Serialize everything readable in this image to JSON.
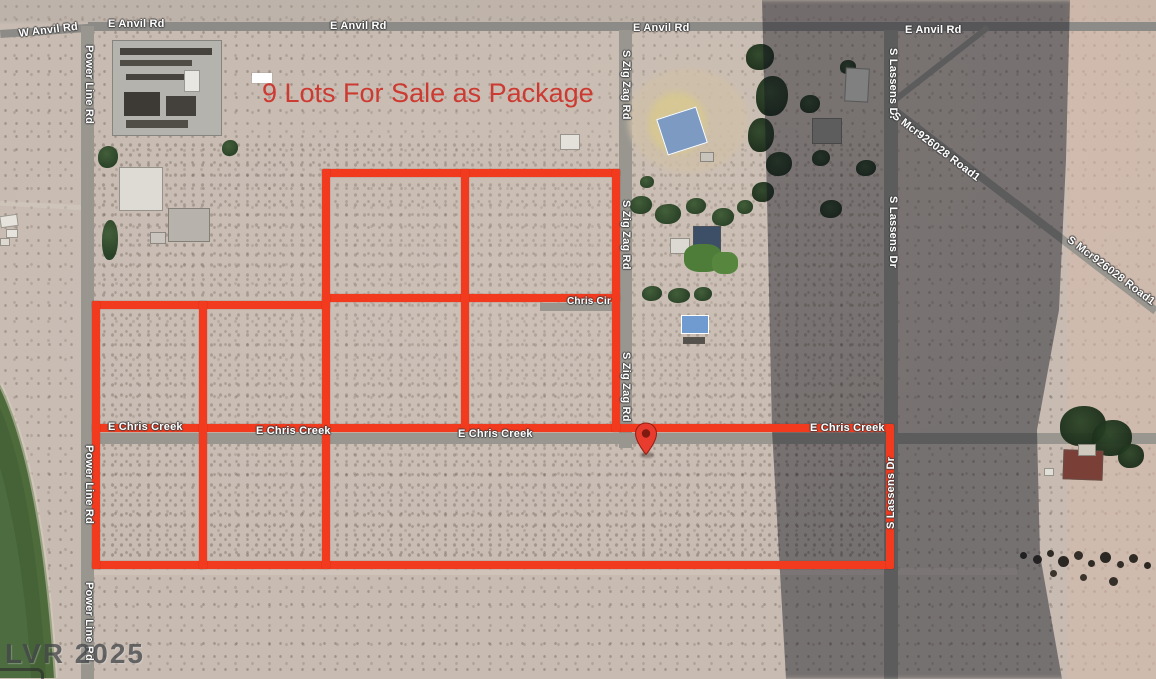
{
  "map": {
    "listing_banner": {
      "text": "9 Lots For Sale as Package",
      "text_color": "#cc3a31",
      "bg_color": "#ffffff",
      "lot_count": 9
    },
    "watermark": {
      "text": "LVR 2025"
    },
    "marker": {
      "name": "location-pin",
      "color": "#e83c2e",
      "x": 646,
      "y": 455
    },
    "colors": {
      "lot_outline_red": "#f23a1e",
      "road_gray": "#98968f",
      "desert_tan": "#c7bbb2",
      "shadow": "rgba(16,19,30,0.44)",
      "field_green": "#4e6b3c",
      "label_text": "#ffffff"
    },
    "road_labels": [
      {
        "text": "W Anvil Rd",
        "x": 18,
        "y": 28,
        "rot": -7,
        "size": 11
      },
      {
        "text": "E Anvil Rd",
        "x": 108,
        "y": 18,
        "rot": 0,
        "size": 11
      },
      {
        "text": "E Anvil Rd",
        "x": 330,
        "y": 20,
        "rot": 0,
        "size": 11
      },
      {
        "text": "E Anvil Rd",
        "x": 633,
        "y": 22,
        "rot": 0,
        "size": 11
      },
      {
        "text": "E Anvil Rd",
        "x": 905,
        "y": 24,
        "rot": 0,
        "size": 11
      },
      {
        "text": "Power Line Rd",
        "x": 95,
        "y": 45,
        "rot": 90,
        "size": 11
      },
      {
        "text": "Power Line Rd",
        "x": 95,
        "y": 445,
        "rot": 90,
        "size": 11
      },
      {
        "text": "Power Line Rd",
        "x": 95,
        "y": 582,
        "rot": 90,
        "size": 11
      },
      {
        "text": "S Zig Zag Rd",
        "x": 632,
        "y": 50,
        "rot": 90,
        "size": 11
      },
      {
        "text": "S Zig Zag Rd",
        "x": 632,
        "y": 200,
        "rot": 90,
        "size": 11
      },
      {
        "text": "S Zig Zag Rd",
        "x": 632,
        "y": 352,
        "rot": 90,
        "size": 11
      },
      {
        "text": "S Lassens Dr",
        "x": 899,
        "y": 48,
        "rot": 90,
        "size": 11
      },
      {
        "text": "S Lassens Dr",
        "x": 899,
        "y": 196,
        "rot": 90,
        "size": 11
      },
      {
        "text": "S Lassens Dr",
        "x": 885,
        "y": 529,
        "rot": -90,
        "size": 11
      },
      {
        "text": "Chris Cir",
        "x": 567,
        "y": 296,
        "rot": 0,
        "size": 10
      },
      {
        "text": "E Chris Creek",
        "x": 108,
        "y": 421,
        "rot": 0,
        "size": 11
      },
      {
        "text": "E Chris Creek",
        "x": 256,
        "y": 425,
        "rot": 0,
        "size": 11
      },
      {
        "text": "E Chris Creek",
        "x": 458,
        "y": 428,
        "rot": 0,
        "size": 11
      },
      {
        "text": "E Chris Creek",
        "x": 810,
        "y": 422,
        "rot": 0,
        "size": 11
      },
      {
        "text": "S Mcr926028 Road1",
        "x": 897,
        "y": 110,
        "rot": 37,
        "size": 11
      },
      {
        "text": "S Mcr926028 Road1",
        "x": 1072,
        "y": 234,
        "rot": 37,
        "size": 11
      }
    ],
    "roads": [
      {
        "name": "road-e-anvil",
        "x": 88,
        "y": 22,
        "w": 1068,
        "h": 9,
        "rot": 0,
        "dark": true
      },
      {
        "name": "road-w-anvil",
        "x": 0,
        "y": 30,
        "w": 92,
        "h": 8,
        "rot": -4,
        "dark": true
      },
      {
        "name": "road-power-line",
        "x": 81,
        "y": 26,
        "w": 13,
        "h": 653,
        "rot": 0,
        "dark": false
      },
      {
        "name": "road-s-zig-zag",
        "x": 619,
        "y": 30,
        "w": 13,
        "h": 418,
        "rot": 0,
        "dark": false
      },
      {
        "name": "road-e-chris-creek",
        "x": 81,
        "y": 433,
        "w": 1075,
        "h": 11,
        "rot": 0,
        "dark": false
      },
      {
        "name": "road-chris-cir",
        "x": 540,
        "y": 303,
        "w": 82,
        "h": 8,
        "rot": 0,
        "dark": false
      },
      {
        "name": "road-s-lassens",
        "x": 884,
        "y": 30,
        "w": 14,
        "h": 649,
        "rot": 0,
        "dark": false
      },
      {
        "name": "road-mcr926028",
        "x": 890,
        "y": 102,
        "w": 338,
        "h": 8,
        "rot": 37.5,
        "dark": false
      },
      {
        "name": "road-mcr926028-spur",
        "x": 890,
        "y": 100,
        "w": 122,
        "h": 6,
        "rot": -38,
        "dark": false
      }
    ],
    "lot_lines": {
      "thickness": 8,
      "horizontal": [
        {
          "x": 322,
          "y": 169,
          "len": 298
        },
        {
          "x": 322,
          "y": 294,
          "len": 298
        },
        {
          "x": 92,
          "y": 301,
          "len": 238
        },
        {
          "x": 92,
          "y": 424,
          "len": 802
        },
        {
          "x": 92,
          "y": 561,
          "len": 802
        }
      ],
      "vertical": [
        {
          "x": 92,
          "y": 301,
          "len": 268
        },
        {
          "x": 199,
          "y": 301,
          "len": 268
        },
        {
          "x": 322,
          "y": 169,
          "len": 400
        },
        {
          "x": 461,
          "y": 169,
          "len": 263
        },
        {
          "x": 612,
          "y": 169,
          "len": 263
        },
        {
          "x": 886,
          "y": 424,
          "len": 145
        }
      ]
    }
  }
}
